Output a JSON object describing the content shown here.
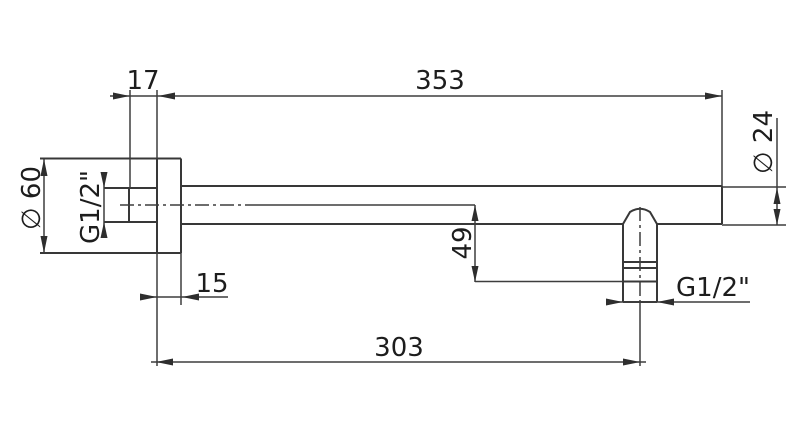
{
  "drawing": {
    "kind": "technical-dimension-drawing",
    "background_color": "#ffffff",
    "line_color": "#383838",
    "text_color": "#1d1d1d",
    "labels": {
      "wall_offset": "17",
      "arm_length": "353",
      "flange_diameter": "∅ 60",
      "wall_thread": "G1/2\"",
      "flange_thickness": "15",
      "drop_height": "49",
      "center_distance": "303",
      "tube_diameter": "∅ 24",
      "outlet_thread": "G1/2\""
    }
  }
}
